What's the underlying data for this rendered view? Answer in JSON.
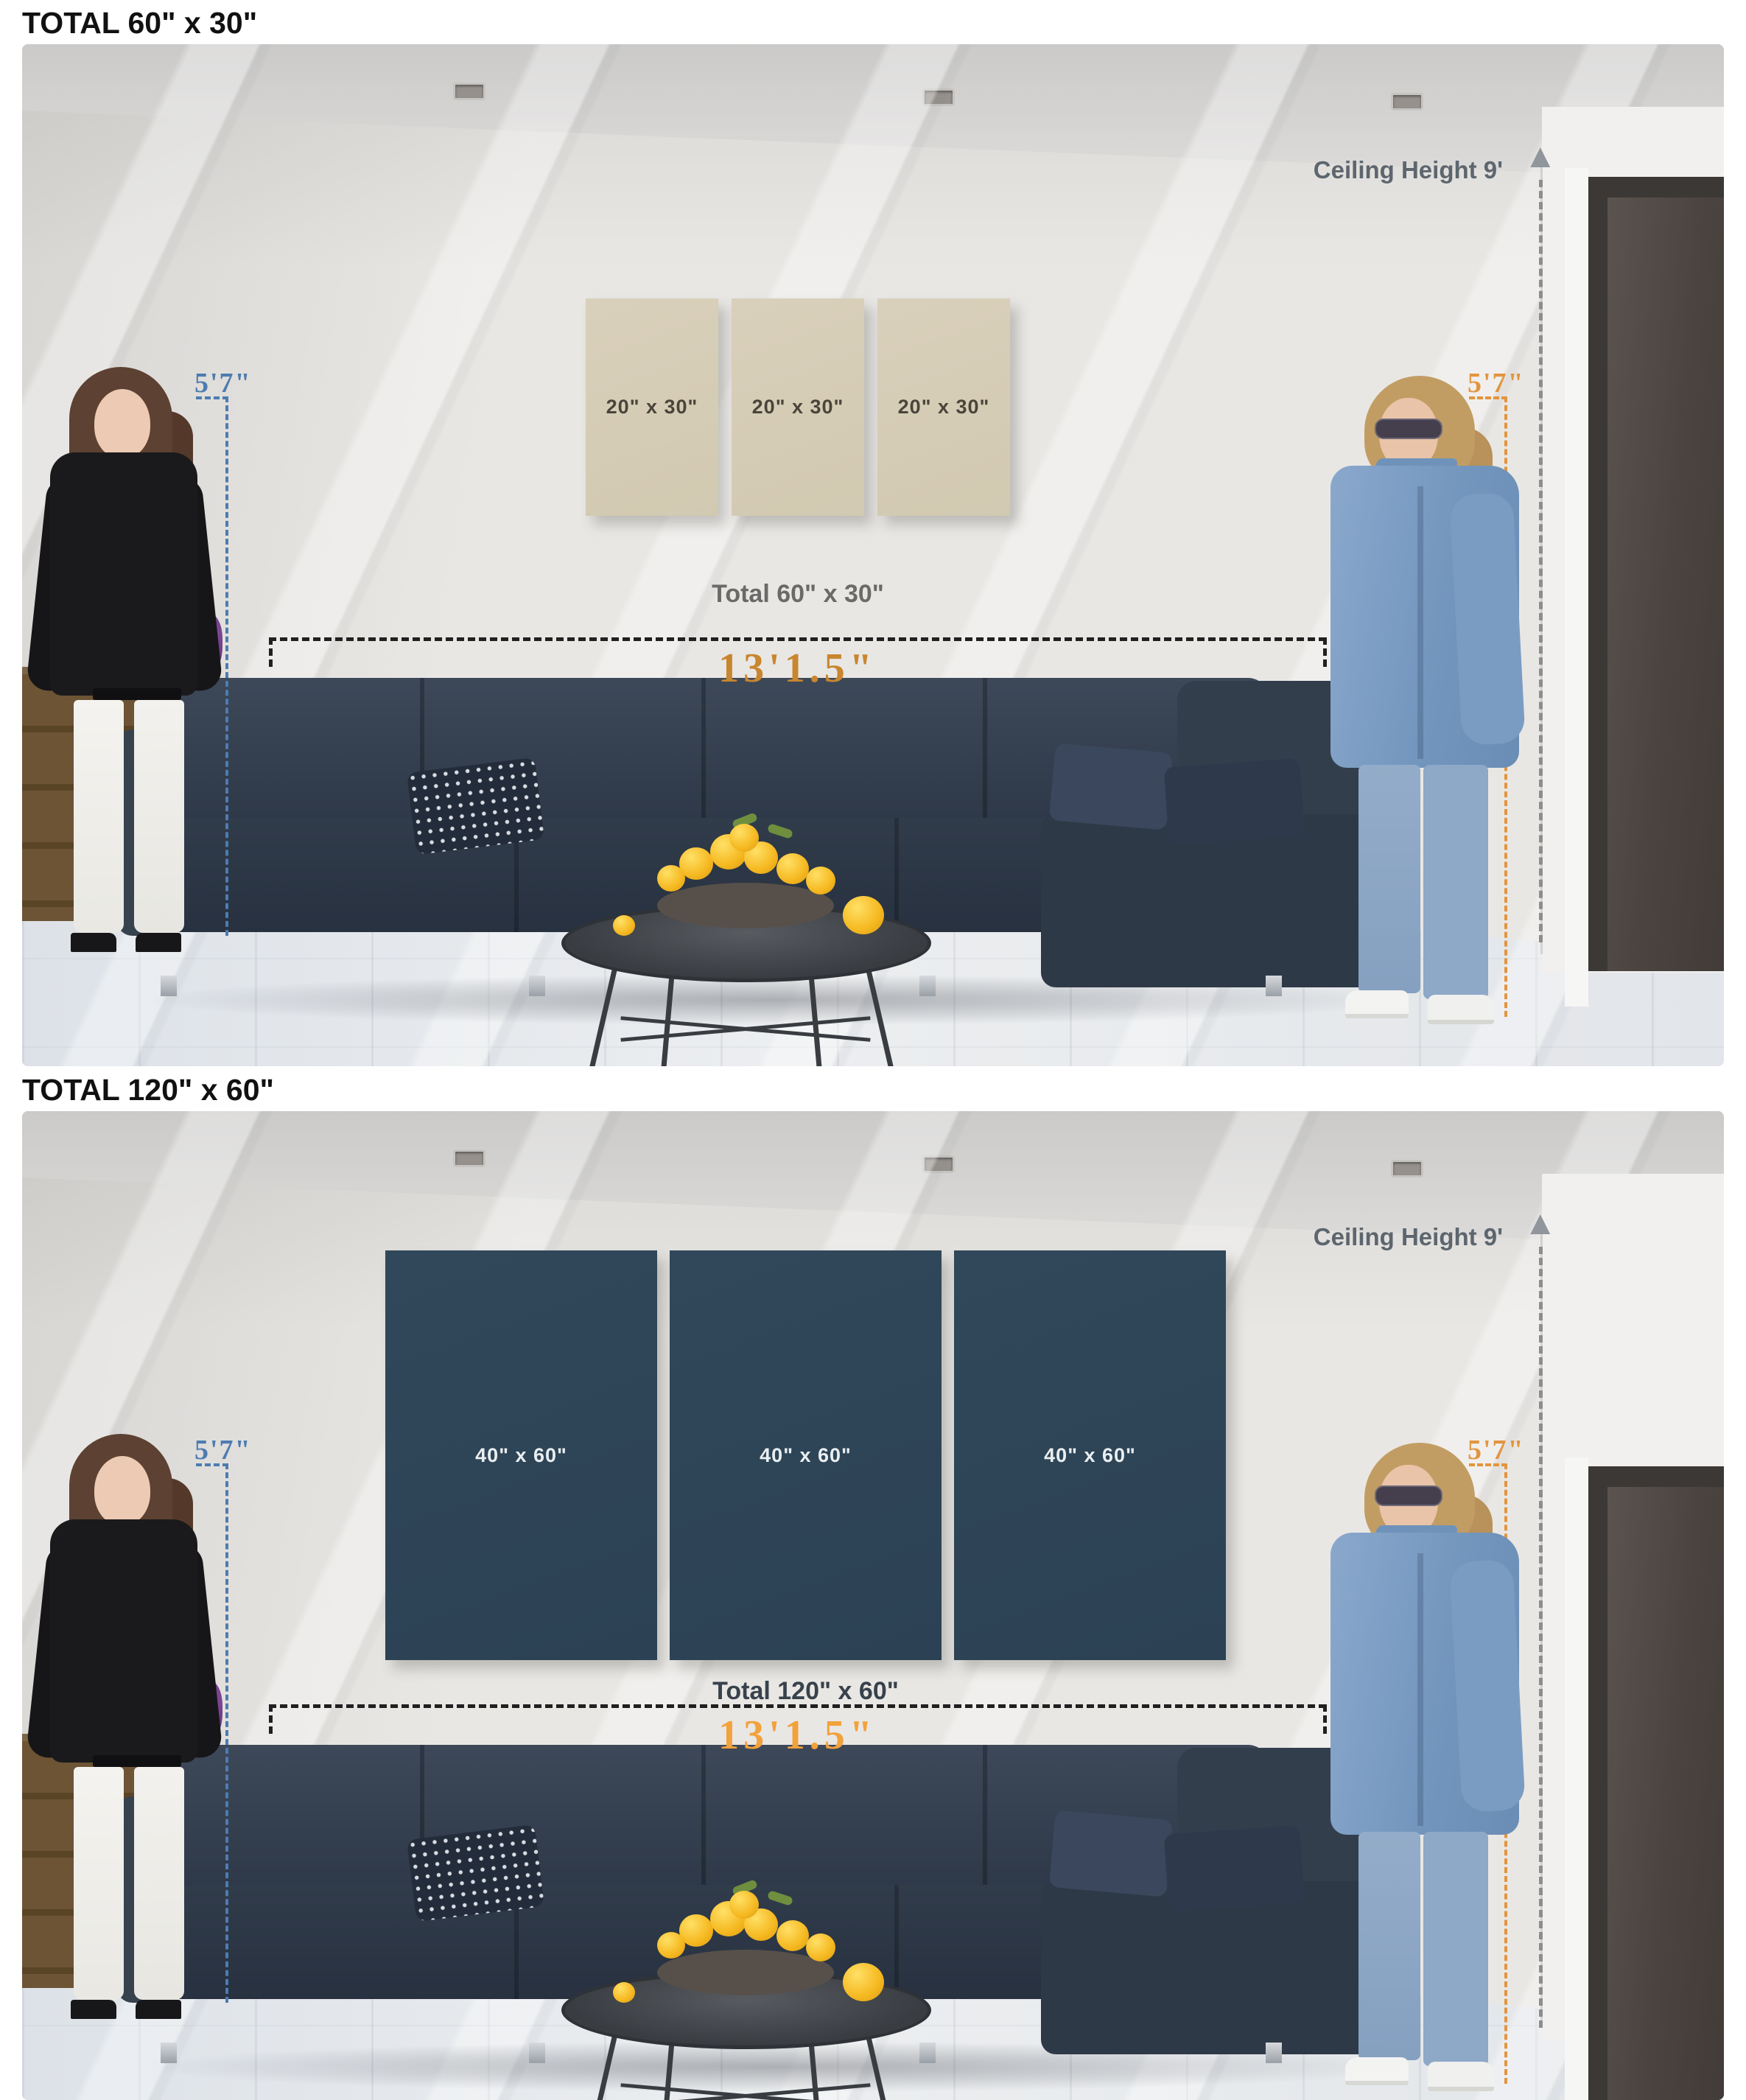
{
  "panels": [
    {
      "heading": "TOTAL 60\" x 30\"",
      "canvases": [
        {
          "label": "20\" x 30\""
        },
        {
          "label": "20\" x 30\""
        },
        {
          "label": "20\" x 30\""
        }
      ],
      "total_label": "Total 60\" x 30\"",
      "ceiling_label": "Ceiling Height 9'",
      "left_person_height": "5'7\"",
      "right_person_height": "5'7\"",
      "sofa_width_label": "13'1.5\"",
      "canvas_color": "#d6cdb7",
      "canvas_label_color": "#4b443a",
      "width_label_color": "#c8862f"
    },
    {
      "heading": "TOTAL 120\" x 60\"",
      "canvases": [
        {
          "label": "40\" x 60\""
        },
        {
          "label": "40\" x 60\""
        },
        {
          "label": "40\" x 60\""
        }
      ],
      "total_label": "Total 120\" x 60\"",
      "ceiling_label": "Ceiling Height 9'",
      "left_person_height": "5'7\"",
      "right_person_height": "5'7\"",
      "sofa_width_label": "13'1.5\"",
      "canvas_color": "#2e4557",
      "canvas_label_color": "#e9eef1",
      "width_label_color": "#f2a23c"
    }
  ],
  "annotation_colors": {
    "left_height": "#4d7cb0",
    "right_height": "#e2953f",
    "ceiling_label": "#5d666e",
    "measure_line": "#202020"
  },
  "icons": {
    "ceiling_arrow": "up-arrow"
  }
}
